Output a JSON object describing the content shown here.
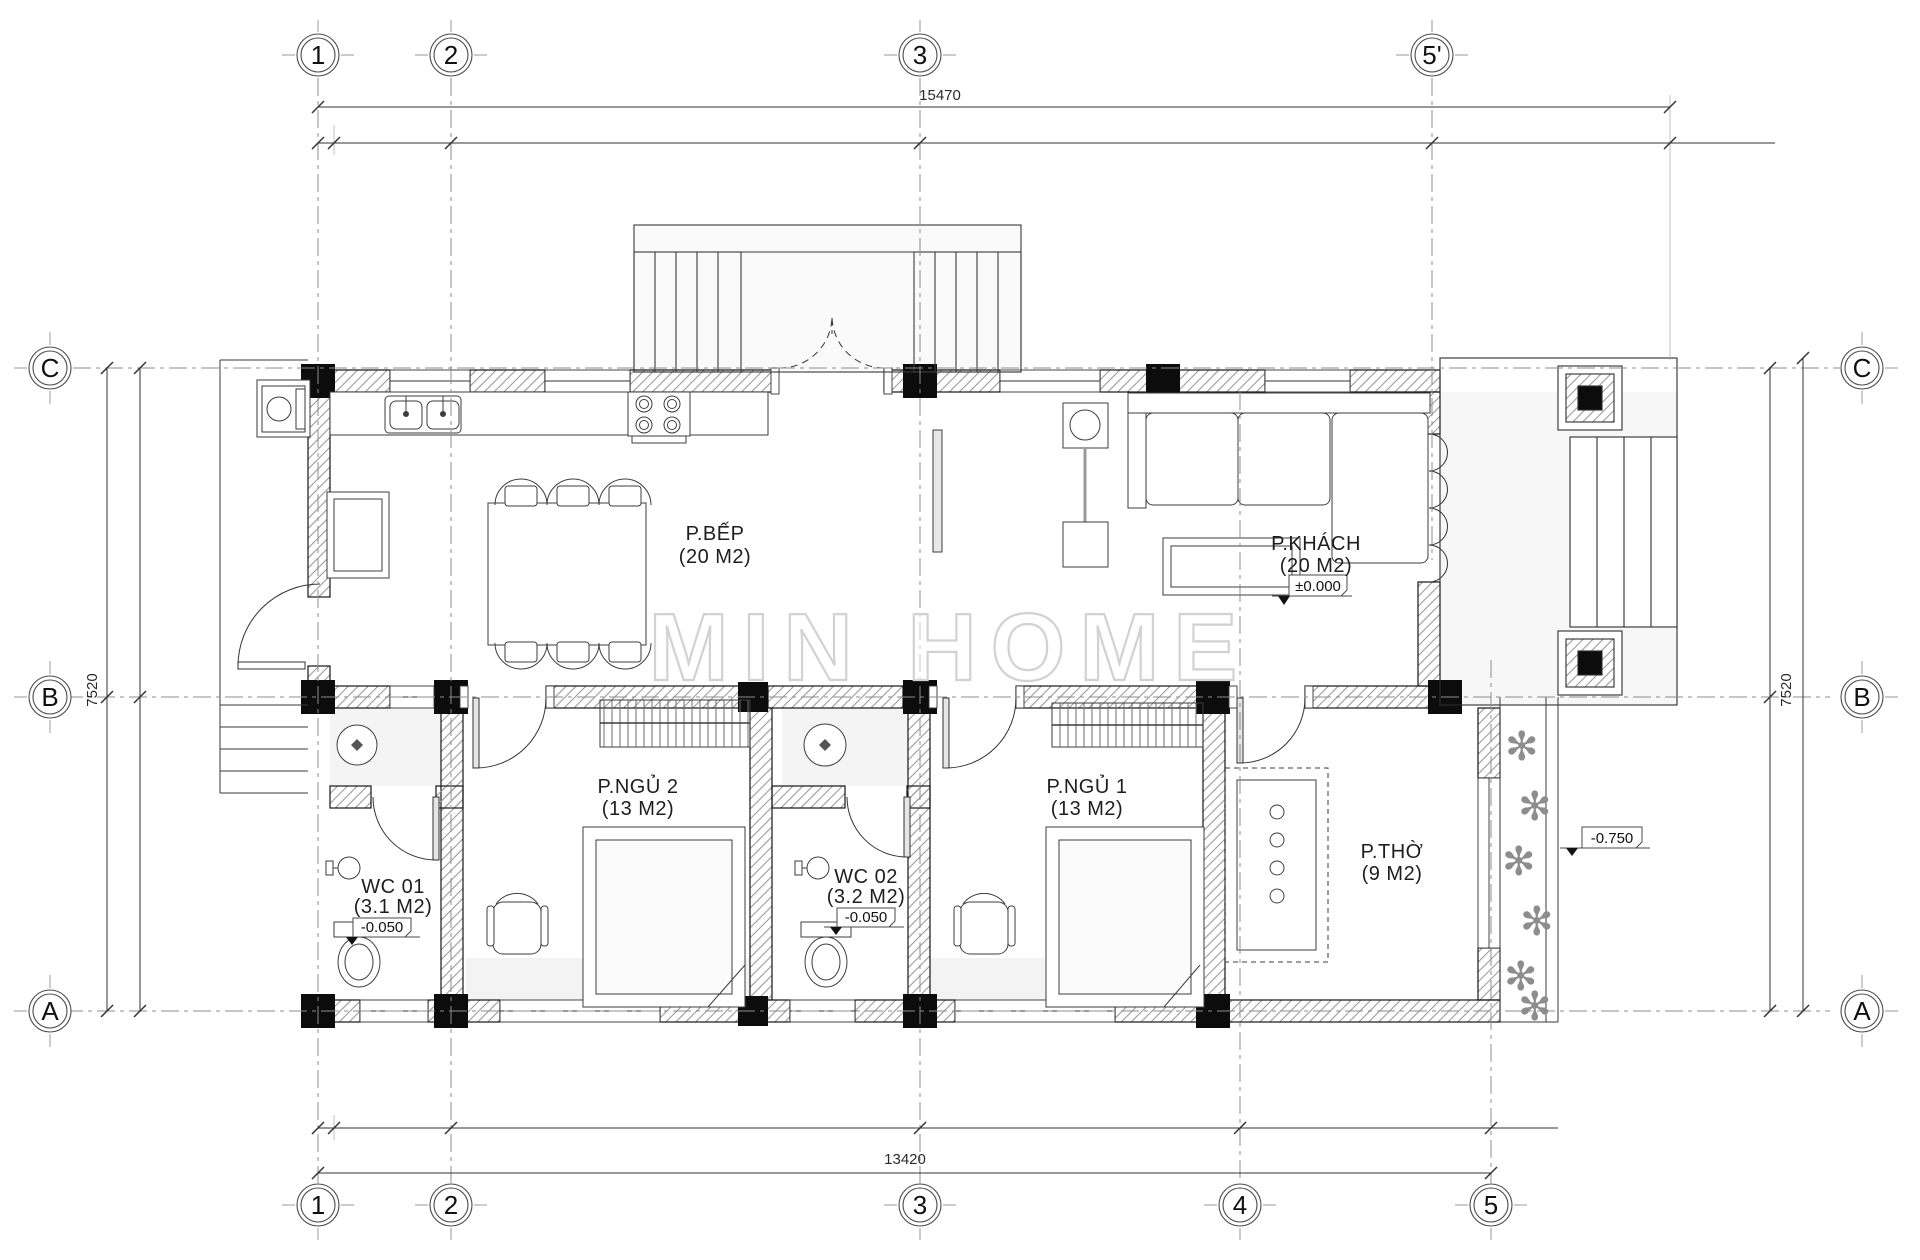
{
  "watermark": "MIN HOME",
  "icons": {
    "plant": "✻"
  },
  "grid": {
    "top": [
      "1",
      "2",
      "3",
      "5'"
    ],
    "bottom": [
      "1",
      "2",
      "3",
      "4",
      "5"
    ],
    "left": [
      "C",
      "B",
      "A"
    ],
    "right": [
      "C",
      "B",
      "A"
    ]
  },
  "dimensions": {
    "top": "15470",
    "bottom": "13420",
    "left": "7520",
    "right": "7520"
  },
  "rooms": {
    "kitchen": {
      "name": "P.BẾP",
      "area": "(20 M2)"
    },
    "living": {
      "name": "P.KHÁCH",
      "area": "(20 M2)",
      "level": "±0.000"
    },
    "bedroom2": {
      "name": "P.NGỦ 2",
      "area": "(13 M2)"
    },
    "bedroom1": {
      "name": "P.NGỦ 1",
      "area": "(13 M2)"
    },
    "wc1": {
      "name": "WC 01",
      "area": "(3.1 M2)",
      "level": "-0.050"
    },
    "wc2": {
      "name": "WC 02",
      "area": "(3.2 M2)",
      "level": "-0.050"
    },
    "altar_room": {
      "name": "P.THỜ",
      "area": "(9 M2)"
    }
  },
  "site": {
    "terrace_level": "-0.750"
  }
}
